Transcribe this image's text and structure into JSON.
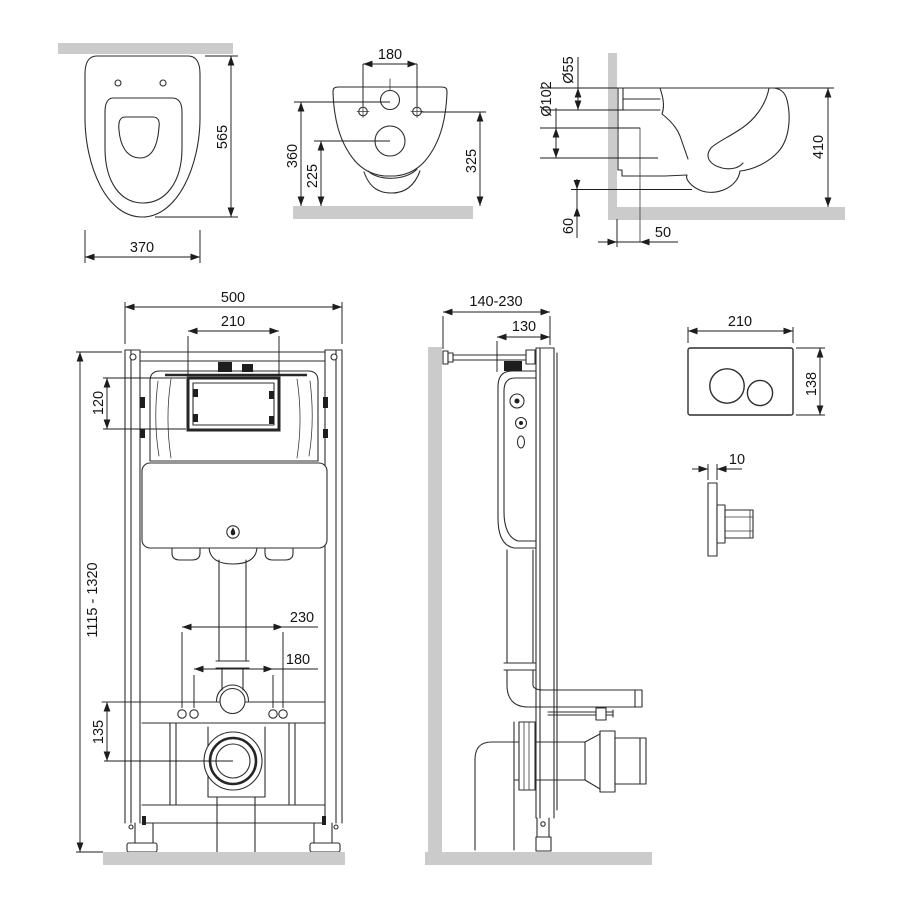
{
  "colors": {
    "line": "#2d2d2d",
    "dimension": "#1d1d1d",
    "wall_floor_section": "#cbcbcb",
    "background": "#ffffff"
  },
  "views": {
    "toilet_top": {
      "dims": {
        "length": "565",
        "width": "370"
      }
    },
    "toilet_rear": {
      "dims": {
        "bolt_spacing": "180",
        "flush_inlet_height": "360",
        "drain_height": "225",
        "bolt_height": "325"
      }
    },
    "toilet_side": {
      "dims": {
        "flush_inlet_diameter": "Ø55",
        "drain_diameter": "Ø102",
        "height": "410",
        "outlet_bottom_height": "60",
        "outlet_wall_offset": "50"
      }
    },
    "frame_front": {
      "dims": {
        "frame_width": "500",
        "window_width": "210",
        "window_height": "120",
        "frame_height_range": "1115 - 1320",
        "outer_bolt_spacing": "230",
        "inner_bolt_spacing": "180",
        "bar_to_drain": "135"
      }
    },
    "frame_side": {
      "dims": {
        "wall_distance_range": "140-230",
        "frame_depth": "130"
      }
    },
    "flush_plate": {
      "dims": {
        "plate_width": "210",
        "plate_height": "138",
        "plate_thickness": "10"
      }
    }
  }
}
